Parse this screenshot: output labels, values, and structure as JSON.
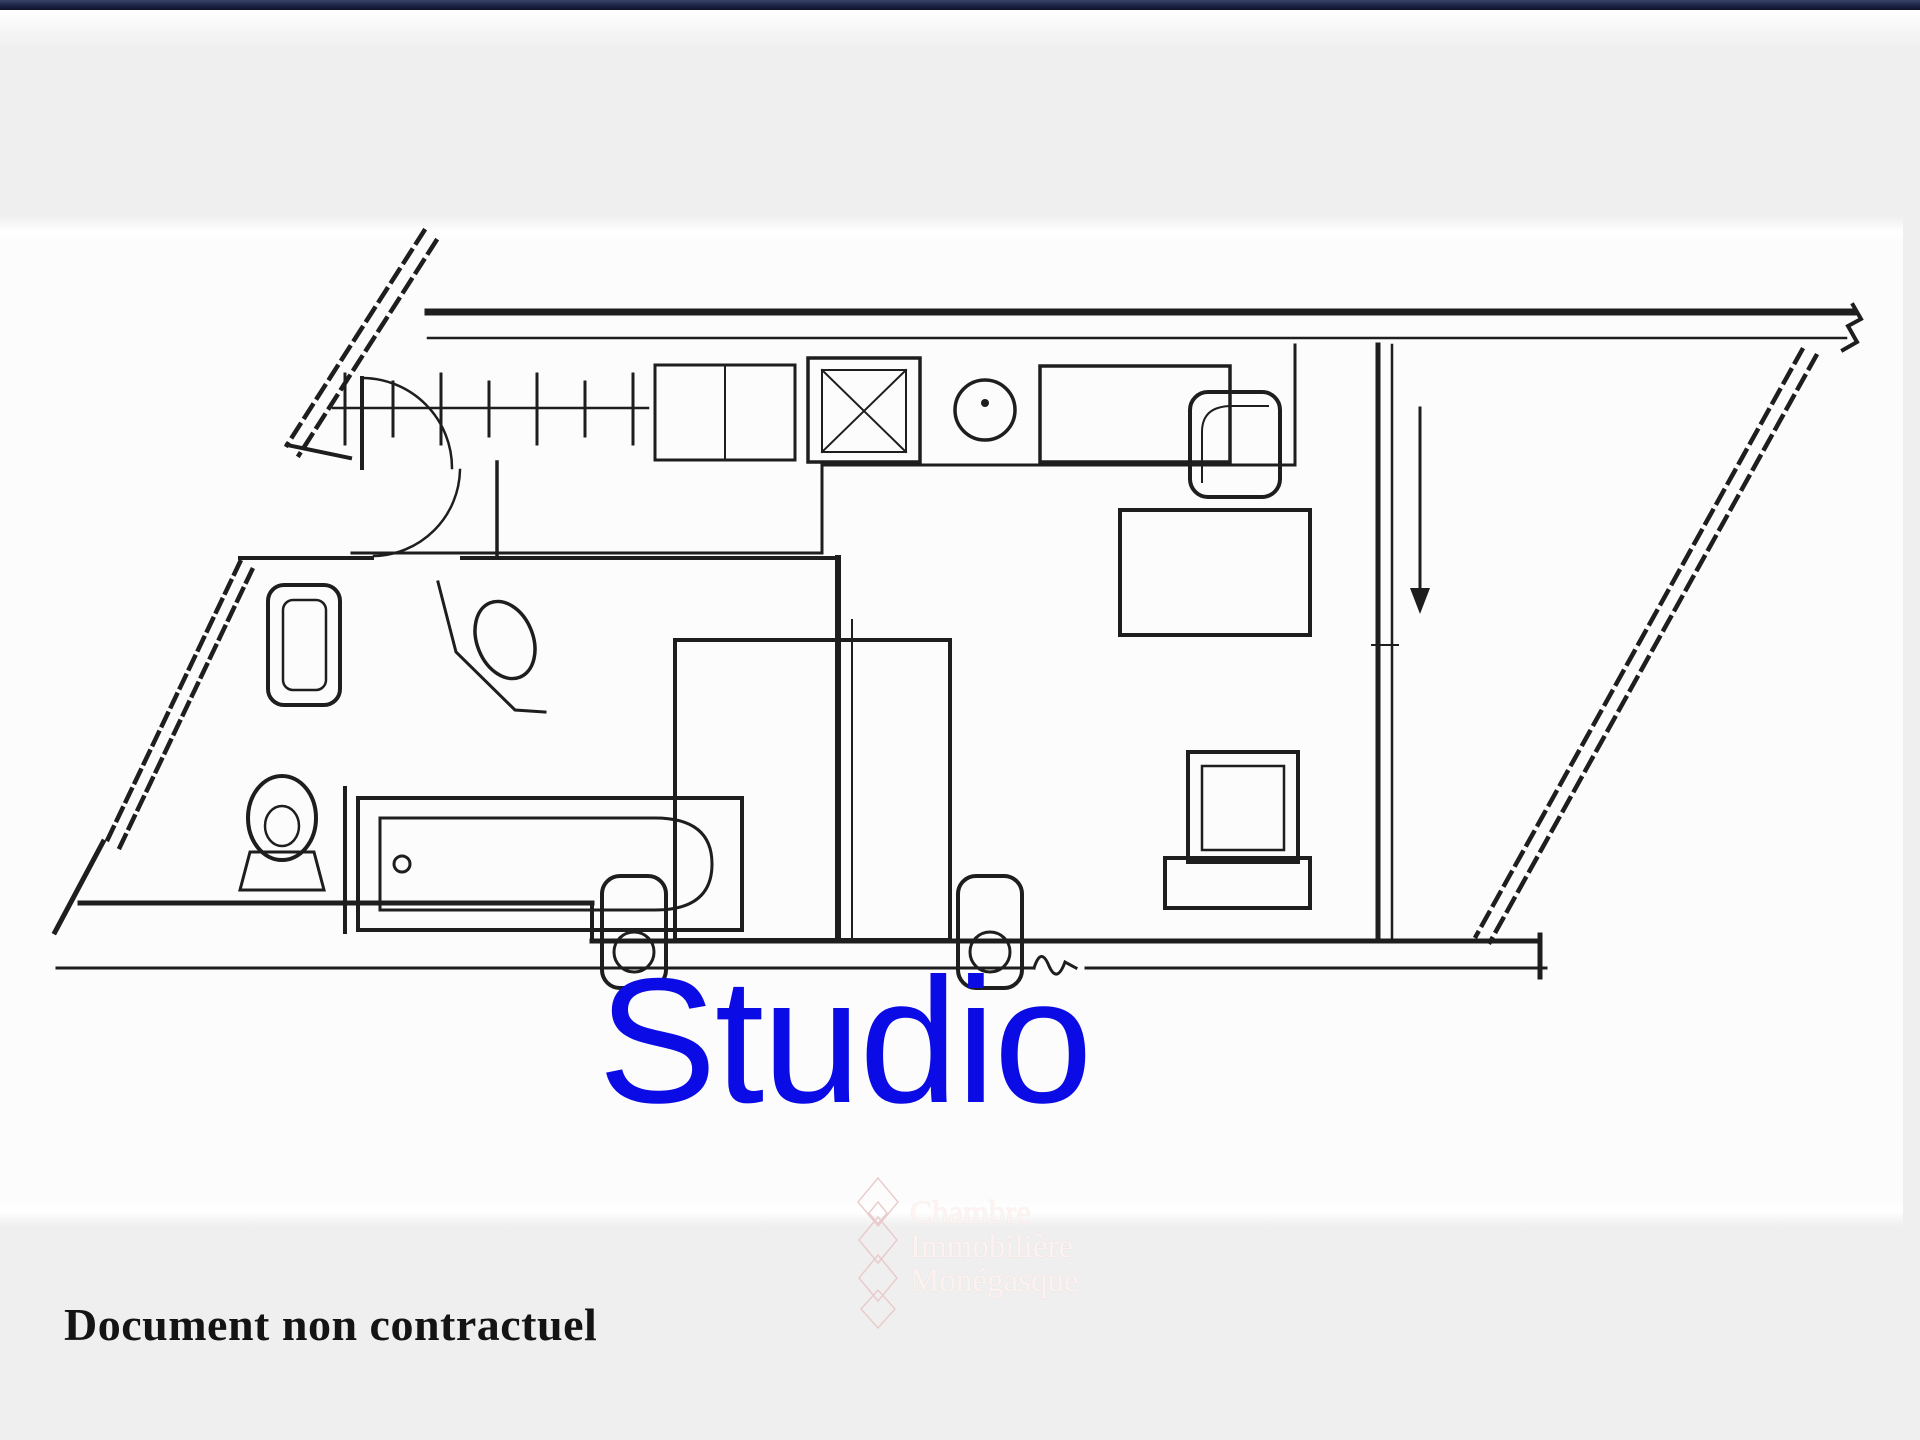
{
  "page": {
    "background_color": "#efefef",
    "topbar_color": "#1c2546",
    "panel_color": "#fcfcfc"
  },
  "plan": {
    "label": "Studio",
    "label_color": "#0b0be6",
    "line_color": "#1e1e1e",
    "fixtures": [
      "radiator-icon",
      "kitchen-cabinet-icon",
      "hob-icon",
      "kitchen-sink-icon",
      "armchair-icon",
      "table-icon",
      "bed-icon",
      "nightstand-icon",
      "tv-icon",
      "toilet-icon",
      "washbasin-icon",
      "bathtub-icon",
      "door-arc-icon",
      "window-dashed-icon",
      "direction-arrow-icon"
    ]
  },
  "watermark": {
    "lines": [
      "Chambre",
      "Immobilière",
      "Monégasque"
    ],
    "text_color": "#fdf4f2",
    "diamond_color": "#e8c6c6",
    "logo": "diamond-chain-icon"
  },
  "footer": {
    "note": "Document non contractuel"
  }
}
